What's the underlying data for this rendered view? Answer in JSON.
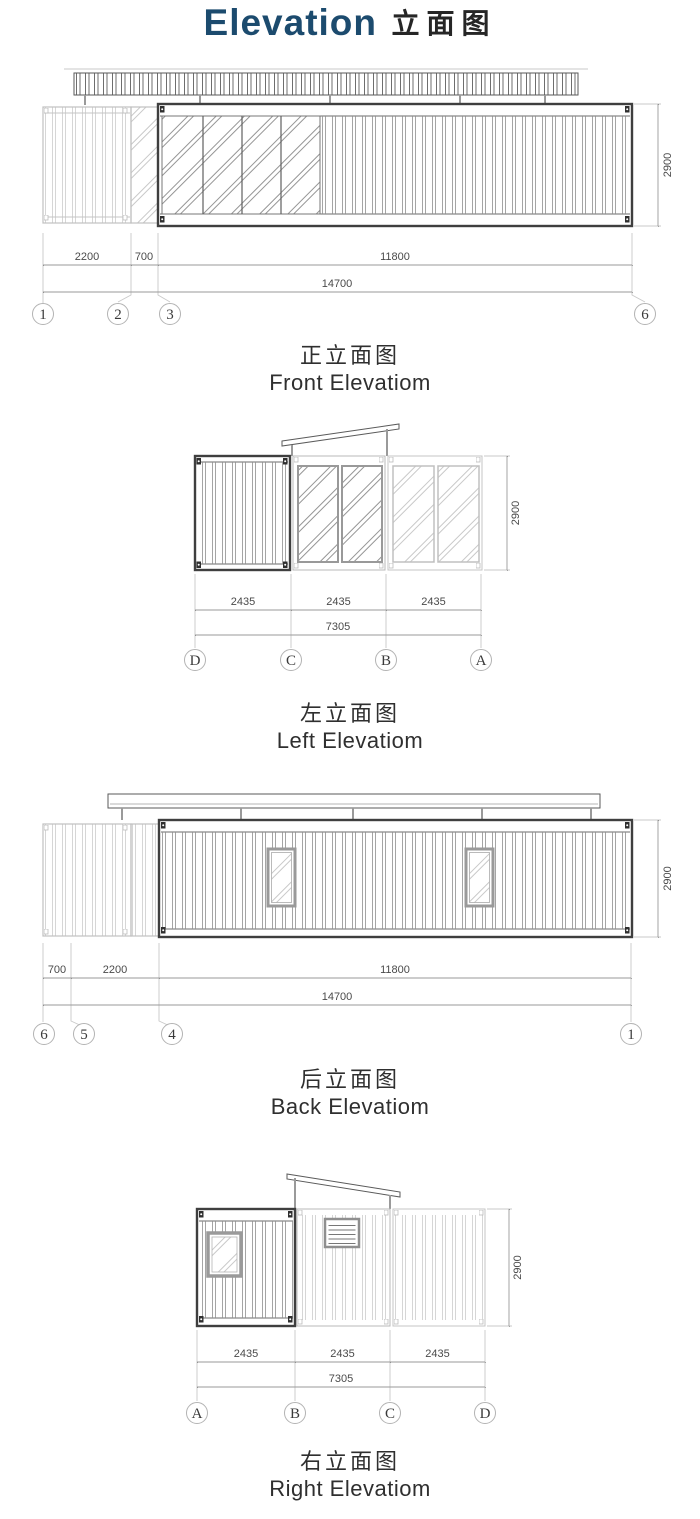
{
  "title": {
    "en": "Elevation",
    "zh": "立面图"
  },
  "colors": {
    "title_blue": "#1c4b6e",
    "drawing_dark": "#3f3f3f",
    "drawing_light": "#c0c0c0",
    "text_dark": "#2f2f2f"
  },
  "front": {
    "label_zh": "正立面图",
    "label_en": "Front Elevatiom",
    "height": "2900",
    "dims": [
      "2200",
      "700",
      "11800"
    ],
    "total": "14700",
    "grids": [
      "1",
      "2",
      "3",
      "6"
    ]
  },
  "left": {
    "label_zh": "左立面图",
    "label_en": "Left Elevatiom",
    "height": "2900",
    "dims": [
      "2435",
      "2435",
      "2435"
    ],
    "total": "7305",
    "grids": [
      "D",
      "C",
      "B",
      "A"
    ]
  },
  "back": {
    "label_zh": "后立面图",
    "label_en": "Back Elevatiom",
    "height": "2900",
    "dims": [
      "700",
      "2200",
      "11800"
    ],
    "total": "14700",
    "grids": [
      "6",
      "5",
      "4",
      "1"
    ]
  },
  "right": {
    "label_zh": "右立面图",
    "label_en": "Right Elevatiom",
    "height": "2900",
    "dims": [
      "2435",
      "2435",
      "2435"
    ],
    "total": "7305",
    "grids": [
      "A",
      "B",
      "C",
      "D"
    ]
  }
}
